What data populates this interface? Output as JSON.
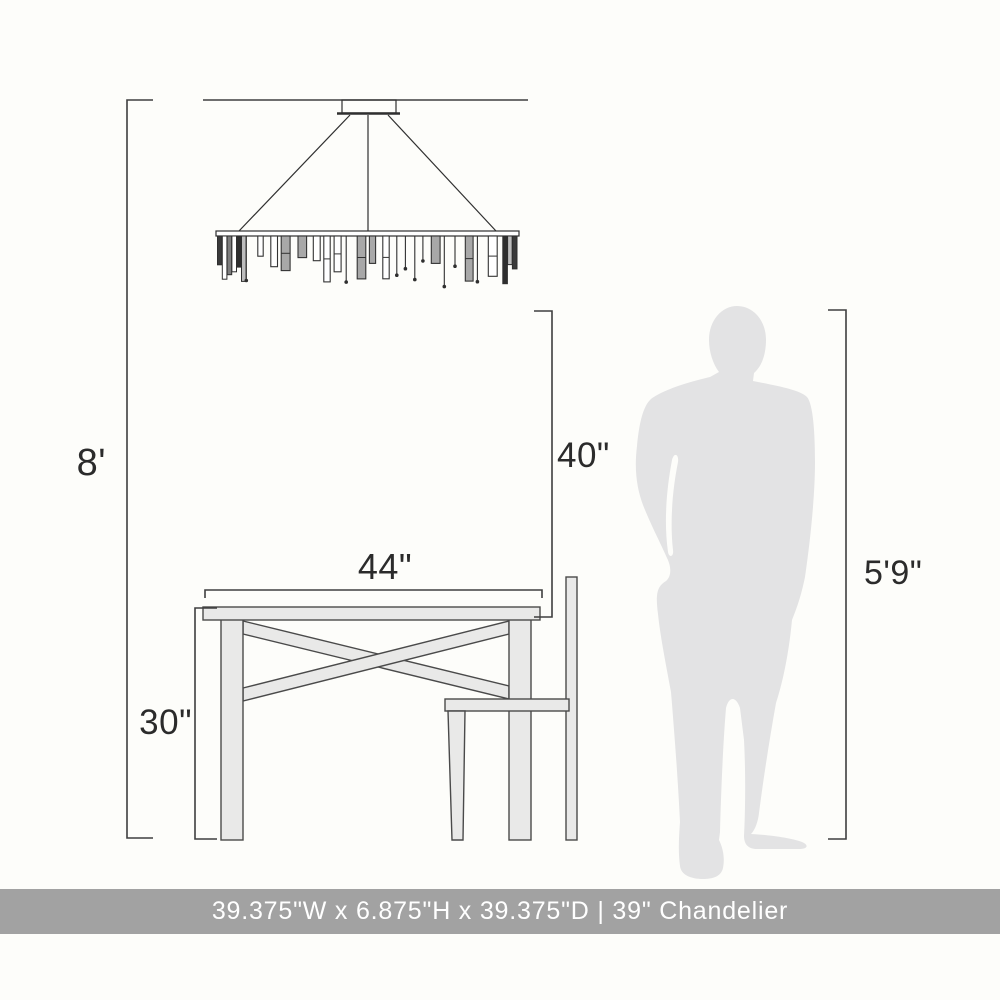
{
  "diagram": {
    "dimensions": {
      "ceiling_height": "8'",
      "hang_clearance": "40\"",
      "table_width": "44\"",
      "table_height": "30\"",
      "person_height": "5'9\""
    },
    "caption": "39.375\"W x 6.875\"H x 39.375\"D | 39\" Chandelier",
    "colors": {
      "background": "#fdfdfa",
      "line": "#3f3f3f",
      "art": "#2f2f2f",
      "furniture_fill": "#e9e9e8",
      "furniture_stroke": "#4a4a4a",
      "silhouette": "#e3e3e4",
      "caption_bar": "#a2a2a2",
      "caption_text": "#ffffff",
      "label": "#2b2b2b"
    }
  }
}
